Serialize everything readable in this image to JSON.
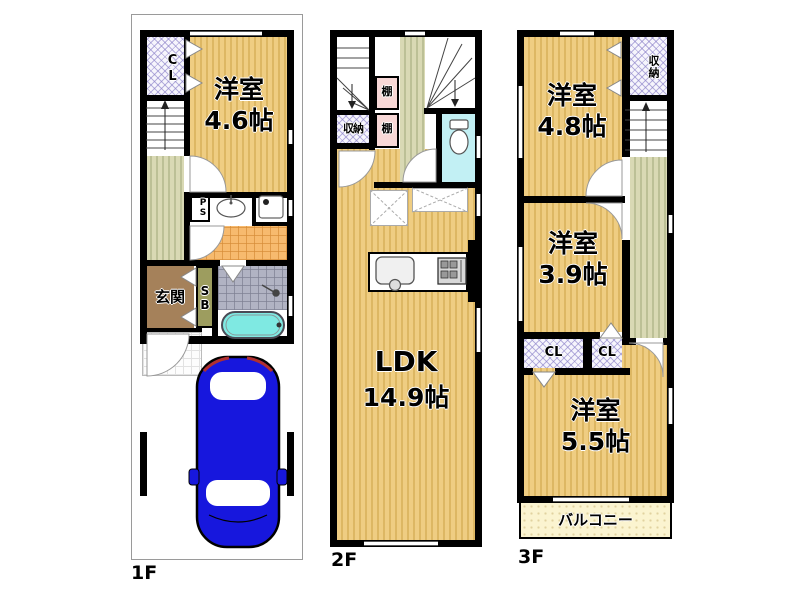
{
  "floors": {
    "f1": {
      "label": "1F",
      "closet": "CL",
      "room": {
        "name": "洋室",
        "size": "4.6帖"
      },
      "pipe_space": "PS",
      "entrance": "玄関",
      "shoe_box": "SB"
    },
    "f2": {
      "label": "2F",
      "shelf1": "棚",
      "shelf2": "棚",
      "storage": "収納",
      "room": {
        "name": "LDK",
        "size": "14.9帖"
      }
    },
    "f3": {
      "label": "3F",
      "storage": "収納",
      "room1": {
        "name": "洋室",
        "size": "4.8帖"
      },
      "room2": {
        "name": "洋室",
        "size": "3.9帖"
      },
      "closet1": "CL",
      "closet2": "CL",
      "room3": {
        "name": "洋室",
        "size": "5.5帖"
      },
      "balcony": "バルコニー"
    }
  },
  "colors": {
    "wall": "#000000",
    "room_floor": "#efcd82",
    "hall_floor": "#d9d9b4",
    "closet_hatch": "#f6f5fc",
    "shelf": "#f8d8d7",
    "toilet_room": "#c2f0f4",
    "washroom_tile": "#f7ba6e",
    "bath_tile": "#b1b3c3",
    "entrance": "#a5815a",
    "shoe_box": "#9d9d5f",
    "balcony": "#fbf4d0",
    "bathtub": "#7fe9e2",
    "car": "#1717dd"
  }
}
